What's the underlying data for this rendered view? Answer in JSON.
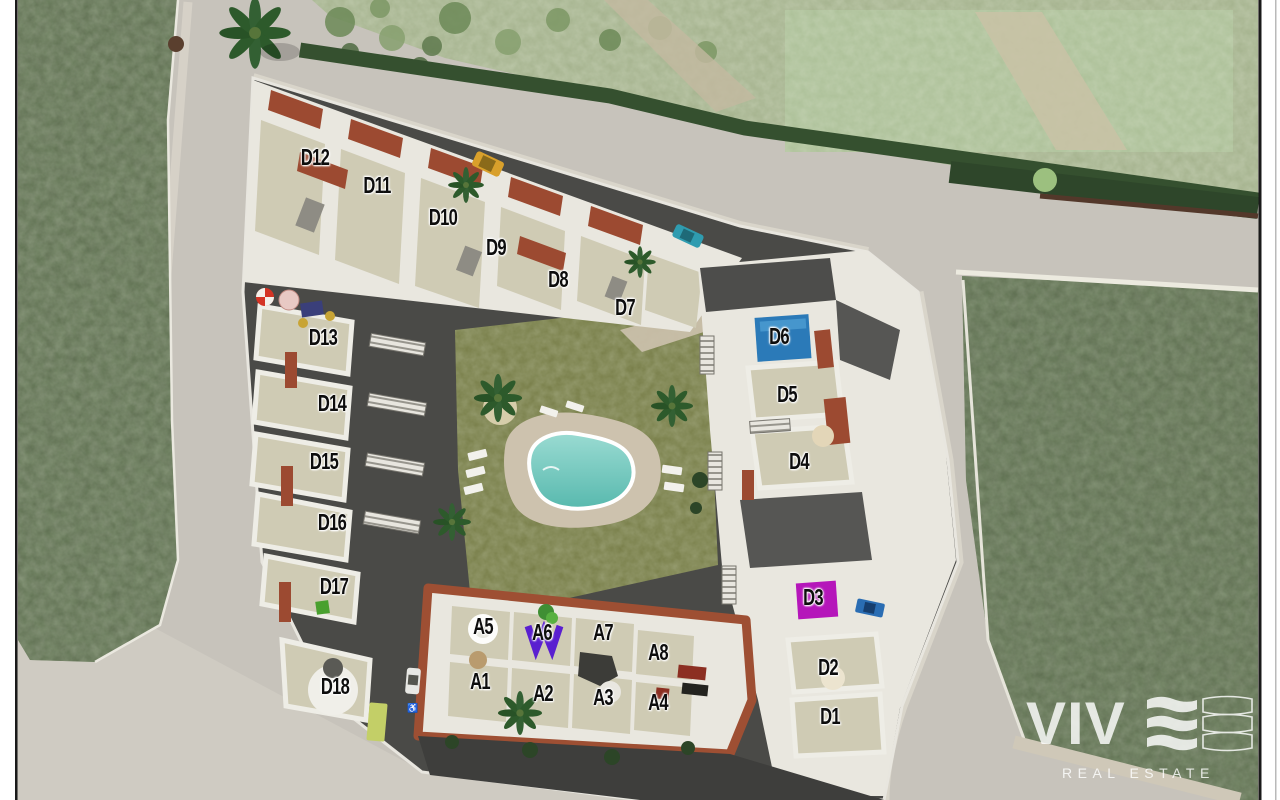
{
  "site_plan": {
    "unit_label_color": "#0d0d0d",
    "units": [
      {
        "id": "D12",
        "x": 315,
        "y": 158
      },
      {
        "id": "D11",
        "x": 377,
        "y": 186
      },
      {
        "id": "D10",
        "x": 443,
        "y": 218
      },
      {
        "id": "D9",
        "x": 496,
        "y": 248
      },
      {
        "id": "D8",
        "x": 558,
        "y": 280
      },
      {
        "id": "D7",
        "x": 625,
        "y": 308
      },
      {
        "id": "D13",
        "x": 323,
        "y": 338
      },
      {
        "id": "D14",
        "x": 332,
        "y": 404
      },
      {
        "id": "D15",
        "x": 324,
        "y": 462
      },
      {
        "id": "D16",
        "x": 332,
        "y": 523
      },
      {
        "id": "D17",
        "x": 334,
        "y": 587
      },
      {
        "id": "D18",
        "x": 335,
        "y": 687
      },
      {
        "id": "D6",
        "x": 779,
        "y": 337
      },
      {
        "id": "D5",
        "x": 787,
        "y": 395
      },
      {
        "id": "D4",
        "x": 799,
        "y": 462
      },
      {
        "id": "D3",
        "x": 813,
        "y": 598
      },
      {
        "id": "D2",
        "x": 828,
        "y": 668
      },
      {
        "id": "D1",
        "x": 830,
        "y": 717
      },
      {
        "id": "A5",
        "x": 483,
        "y": 627
      },
      {
        "id": "A6",
        "x": 542,
        "y": 633
      },
      {
        "id": "A7",
        "x": 603,
        "y": 633
      },
      {
        "id": "A8",
        "x": 658,
        "y": 653
      },
      {
        "id": "A1",
        "x": 480,
        "y": 682
      },
      {
        "id": "A2",
        "x": 543,
        "y": 694
      },
      {
        "id": "A3",
        "x": 603,
        "y": 698
      },
      {
        "id": "A4",
        "x": 658,
        "y": 703
      }
    ]
  },
  "logo": {
    "brand": "VIV",
    "tagline": "REAL ESTATE"
  },
  "colors": {
    "road": "#c7c3bb",
    "road_light": "#cfcbc2",
    "sidewalk": "#d9d5ca",
    "field_dark": "#5c6b4f",
    "field_sage": "#a3b18c",
    "field_paste": "#abbf97",
    "hedge": "#35502f",
    "site_base": "#4a4a47",
    "building_wall": "#e9e7df",
    "terrace": "#cfcbb4",
    "terracotta": "#9c4a31",
    "courtyard": "#767c46",
    "pool_water": "#7fcfc4",
    "pool_deck": "#cdc2ae",
    "accent_blue": "#2b7ab8",
    "accent_magenta": "#b516ba",
    "logo_white": "#ffffff"
  }
}
